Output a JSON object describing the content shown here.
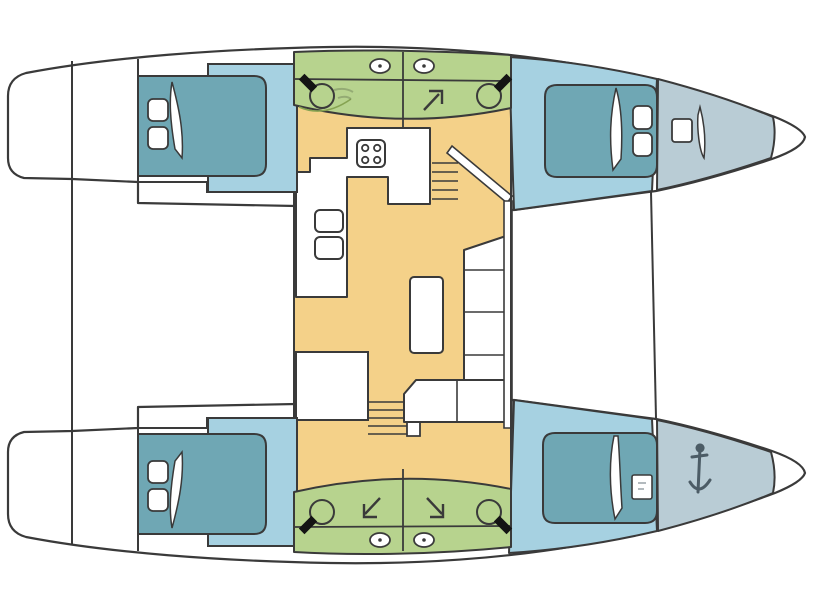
{
  "vessel": {
    "type": "catamaran",
    "view": "top-down deck plan",
    "orientation": {
      "bow": "right",
      "stern": "left",
      "port_hull": "top",
      "starboard_hull": "bottom"
    },
    "counts": {
      "hulls": 2,
      "cabins": 4,
      "double_berths": 4,
      "bathrooms": 4,
      "deck_hatches": 4,
      "companionway_stairs": 2,
      "bow_lockers": 2
    },
    "rooms": [
      {
        "id": "salon",
        "label": "Salon and galley",
        "features": [
          "4-burner stove",
          "double sink",
          "counter",
          "dinette table",
          "L-shaped sofa",
          "bench seat",
          "port companionway stairs",
          "starboard companionway stairs"
        ]
      },
      {
        "id": "cabin-port-aft",
        "label": "Port aft cabin",
        "features": [
          "double berth",
          "two pillows",
          "duvet"
        ]
      },
      {
        "id": "cabin-port-fwd",
        "label": "Port forward cabin",
        "features": [
          "double berth",
          "two pillows",
          "duvet"
        ]
      },
      {
        "id": "cabin-stbd-aft",
        "label": "Starboard aft cabin",
        "features": [
          "double berth",
          "two pillows",
          "duvet"
        ]
      },
      {
        "id": "cabin-stbd-fwd",
        "label": "Starboard forward cabin",
        "features": [
          "double berth",
          "deck hatch",
          "duvet"
        ]
      },
      {
        "id": "bathroom-port-aft",
        "label": "Port aft bathroom",
        "features": [
          "toilet",
          "washbasin",
          "deck hatch"
        ]
      },
      {
        "id": "bathroom-port-fwd",
        "label": "Port forward bathroom",
        "features": [
          "shower",
          "toilet",
          "deck hatch"
        ]
      },
      {
        "id": "bathroom-stbd-aft",
        "label": "Starboard aft bathroom",
        "features": [
          "toilet",
          "shower",
          "deck hatch"
        ]
      },
      {
        "id": "bathroom-stbd-fwd",
        "label": "Starboard forward bathroom",
        "features": [
          "shower",
          "toilet",
          "deck hatch"
        ]
      },
      {
        "id": "bow-locker-port",
        "label": "Port bow locker",
        "features": [
          "deck hatch",
          "locker lid"
        ]
      },
      {
        "id": "bow-locker-stbd",
        "label": "Starboard bow locker",
        "features": [
          "anchor"
        ]
      },
      {
        "id": "cockpit",
        "label": "Aft cockpit"
      },
      {
        "id": "foredeck",
        "label": "Foredeck between bows"
      }
    ],
    "icons": [
      "stove-icon",
      "sink-icon",
      "toilet-icon",
      "shower-arrow-icon",
      "deck-hatch-icon",
      "anchor-icon",
      "stairs",
      "pillow",
      "duvet-fold"
    ],
    "palette": {
      "outline": "#3a3a3a",
      "hull_fill": "#ffffff",
      "berth": "#6fa7b4",
      "cabin_floor": "#a6d1e1",
      "bow_locker": "#b9ccd5",
      "bathroom": "#b7d38e",
      "bathroom_detail": "#86a352",
      "salon_floor": "#f4d189",
      "fixture_white": "#ffffff",
      "seat_black": "#141414",
      "anchor": "#41505a"
    }
  }
}
